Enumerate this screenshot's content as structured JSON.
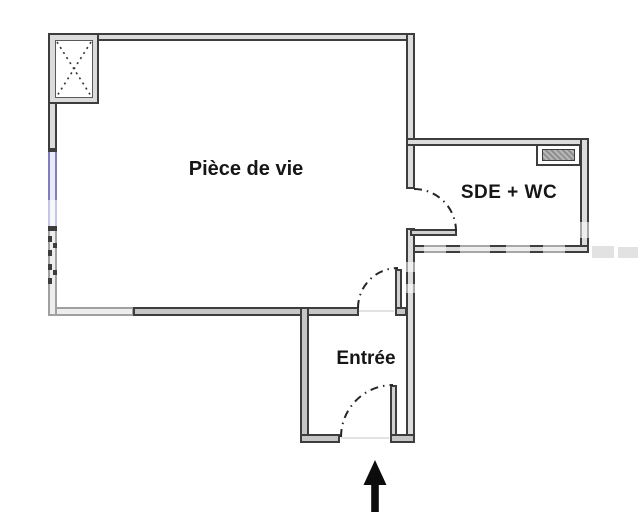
{
  "plan": {
    "rooms": [
      {
        "label": "Pièce de vie"
      },
      {
        "label": "SDE + WC"
      },
      {
        "label": "Entrée"
      }
    ],
    "icons": [
      {
        "name": "shaft-x-symbol"
      },
      {
        "name": "duct-hatch-symbol"
      },
      {
        "name": "window-symbol"
      },
      {
        "name": "entrance-arrow"
      }
    ],
    "colors": {
      "wall_outline": "#3d3d3d",
      "wall_fill": "#dcdcdc",
      "window_blue": "#7c80c3",
      "text": "#161616",
      "arrow": "#0c0c0c",
      "background": "#ffffff"
    }
  }
}
